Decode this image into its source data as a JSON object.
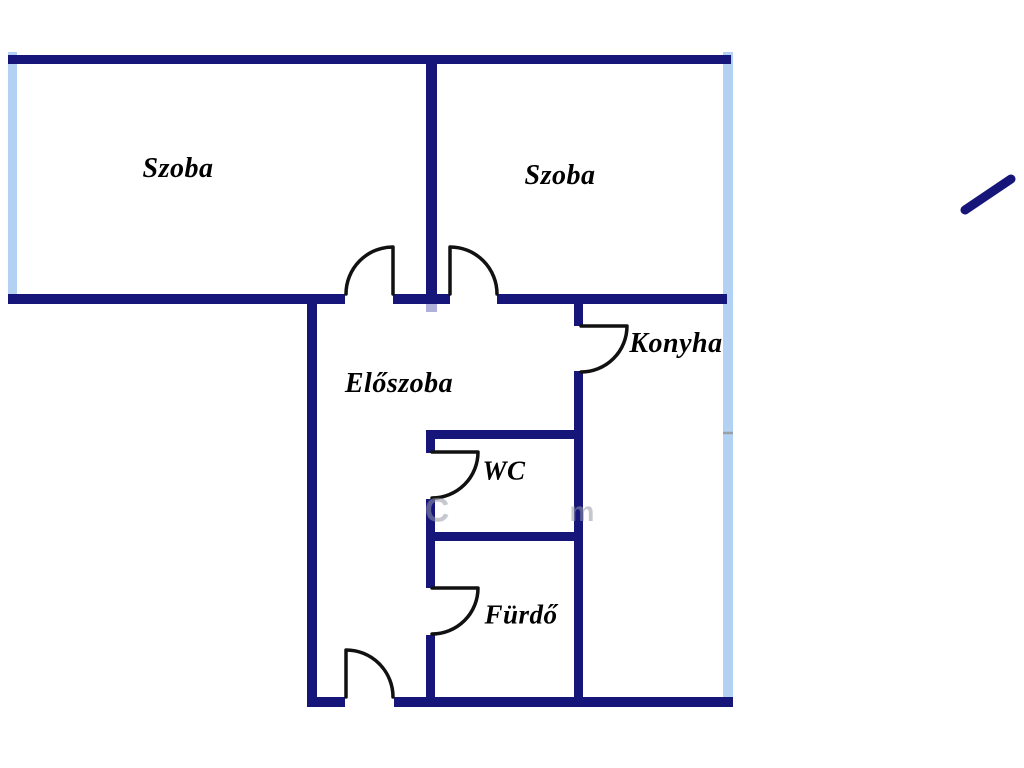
{
  "plan": {
    "type": "apartment-floor-plan",
    "colors": {
      "wall": "#16167a",
      "door_arc": "#111111",
      "window": "#b3d1f2",
      "label_text": "#000000",
      "background": "#ffffff",
      "window_tick": "#9aa0a8",
      "junction_artifact": "#6f6fbe"
    },
    "rooms": [
      {
        "id": "szoba-left",
        "label": "Szoba"
      },
      {
        "id": "szoba-right",
        "label": "Szoba"
      },
      {
        "id": "eloszoba",
        "label": "Előszoba"
      },
      {
        "id": "konyha",
        "label": "Konyha"
      },
      {
        "id": "wc",
        "label": "WC"
      },
      {
        "id": "furdo",
        "label": "Fürdő"
      }
    ],
    "door_count": 6,
    "window_sides": [
      "left",
      "right"
    ],
    "north_mark": "diagonal-line-top-right",
    "watermark_fragments": [
      {
        "text": "C"
      },
      {
        "text": "m"
      }
    ]
  }
}
